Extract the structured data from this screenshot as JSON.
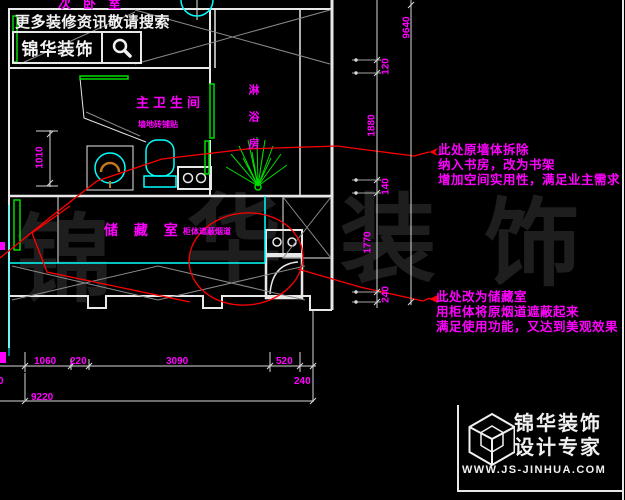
{
  "plan": {
    "top_room_label": "次卧室",
    "promo_text": "更多装修资讯敬请搜索",
    "brand_box_label": "锦华装饰",
    "rooms": {
      "bathroom_label": "主卫生间",
      "bathroom_note": "墙地砖铺贴",
      "side_room_label": "淋浴房",
      "storage_label": "储 藏 室",
      "storage_note": "柜体遮蔽烟道"
    }
  },
  "annotations": [
    {
      "lines": [
        "此处原墙体拆除",
        "纳入书房，改为书架",
        "增加空间实用性，满足业主需求"
      ]
    },
    {
      "lines": [
        "此处改为储藏室",
        "用柜体将原烟道遮蔽起来",
        "满足使用功能，又达到美观效果"
      ]
    }
  ],
  "dimensions": {
    "bottom": {
      "d1": "1060",
      "d2": "220",
      "d3": "3090",
      "d4": "520",
      "d5": "240",
      "partial_left": "0",
      "total": "9220"
    },
    "left": {
      "d1": "1010"
    },
    "right": {
      "d1": "120",
      "d2": "1880",
      "d3": "140",
      "d4": "1770",
      "d5": "240",
      "total": "9640"
    }
  },
  "watermark": {
    "c1": "锦",
    "c2": "华",
    "c3": "装",
    "c4": "饰"
  },
  "footer": {
    "brand_line1": "锦华装饰",
    "brand_line2": "设计专家",
    "website": "WWW.JS-JINHUA.COM"
  },
  "colors": {
    "background": "#000000",
    "linework": "#e8e8e8",
    "label_magenta": "#ff00ff",
    "leader_red": "#ff0000",
    "fixture_cyan": "#00ffff",
    "door_green": "#00dd00",
    "basin_orange": "#c07820",
    "watermark_gray": "#1e1e1e"
  }
}
